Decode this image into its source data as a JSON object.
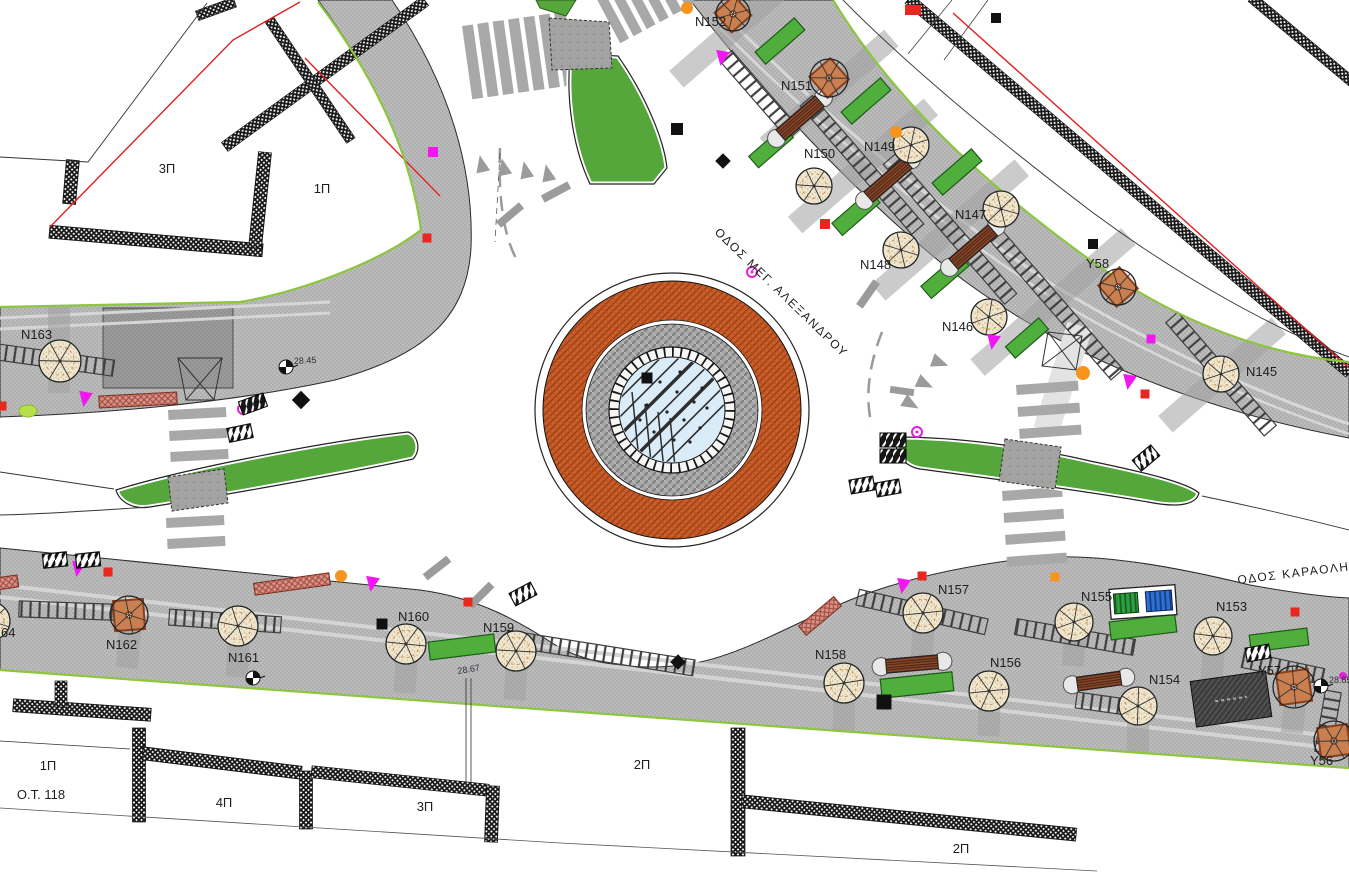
{
  "drawing": {
    "type": "site-plan",
    "units": "px"
  },
  "streets": [
    {
      "id": "meg-alexandrou",
      "name": "ΟΔΟΣ ΜΕΓ. ΑΛΕΞΑΝΔΡΟΥ",
      "x": 714,
      "y": 233,
      "rotate": 44
    },
    {
      "id": "karaoli",
      "name": "ΟΔΟΣ ΚΑΡΑΟΛΗ και",
      "x": 1238,
      "y": 584,
      "rotate": -7
    }
  ],
  "blocks": [
    {
      "text": "3Π",
      "x": 167,
      "y": 173
    },
    {
      "text": "1Π",
      "x": 322,
      "y": 193
    },
    {
      "text": "1Π",
      "x": 48,
      "y": 770
    },
    {
      "text": "Ο.Τ. 118",
      "x": 41,
      "y": 799
    },
    {
      "text": "4Π",
      "x": 224,
      "y": 807
    },
    {
      "text": "3Π",
      "x": 425,
      "y": 811
    },
    {
      "text": "2Π",
      "x": 642,
      "y": 769
    },
    {
      "text": "2Π",
      "x": 961,
      "y": 853
    }
  ],
  "elevations": [
    {
      "text": "28.45",
      "x": 294,
      "y": 364,
      "rot": -3
    },
    {
      "text": "28.67",
      "x": 458,
      "y": 674,
      "rot": -9
    },
    {
      "text": "28.85",
      "x": 1329,
      "y": 683,
      "rot": 0
    }
  ],
  "roundabout": {
    "cx": 672,
    "cy": 410,
    "r_outer": 137,
    "r_brick": 129,
    "r_gap": 90,
    "r_gray": 86,
    "r_tiles": 63,
    "r_glass": 53
  },
  "trees": [
    {
      "id": "N152",
      "x": 733,
      "y": 14,
      "type": "square",
      "r": 17,
      "s": 26,
      "prot": -41,
      "lx": 695,
      "ly": 26
    },
    {
      "id": "N151",
      "x": 829,
      "y": 78,
      "type": "square",
      "r": 19,
      "s": 28,
      "prot": -41,
      "lx": 781,
      "ly": 90
    },
    {
      "id": "N150",
      "x": 814,
      "y": 186,
      "type": "round",
      "r": 18,
      "lx": 804,
      "ly": 158
    },
    {
      "id": "N149",
      "x": 911,
      "y": 145,
      "type": "round",
      "r": 18,
      "lx": 864,
      "ly": 151
    },
    {
      "id": "N148",
      "x": 901,
      "y": 250,
      "type": "round",
      "r": 18,
      "lx": 860,
      "ly": 269
    },
    {
      "id": "N147",
      "x": 1001,
      "y": 209,
      "type": "round",
      "r": 18,
      "lx": 955,
      "ly": 219
    },
    {
      "id": "N146",
      "x": 989,
      "y": 317,
      "type": "round",
      "r": 18,
      "lx": 942,
      "ly": 331
    },
    {
      "id": "Y58",
      "x": 1118,
      "y": 287,
      "type": "square",
      "r": 18,
      "s": 28,
      "prot": -41,
      "lx": 1086,
      "ly": 268
    },
    {
      "id": "N145",
      "x": 1221,
      "y": 374,
      "type": "round",
      "r": 18,
      "lx": 1246,
      "ly": 376
    },
    {
      "id": "N163",
      "x": 60,
      "y": 361,
      "type": "round",
      "r": 21,
      "lx": 21,
      "ly": 339
    },
    {
      "id": "N164",
      "label": "64",
      "x": -9,
      "y": 621,
      "type": "round",
      "r": 19,
      "lx": 1,
      "ly": 637
    },
    {
      "id": "N162",
      "x": 129,
      "y": 615,
      "type": "square",
      "r": 19,
      "s": 30,
      "prot": -4,
      "lx": 106,
      "ly": 649
    },
    {
      "id": "N161",
      "x": 238,
      "y": 626,
      "type": "round",
      "r": 20,
      "lx": 228,
      "ly": 662
    },
    {
      "id": "N160",
      "x": 406,
      "y": 644,
      "type": "round",
      "r": 20,
      "lx": 398,
      "ly": 621
    },
    {
      "id": "N159",
      "x": 516,
      "y": 651,
      "type": "round",
      "r": 20,
      "lx": 483,
      "ly": 632
    },
    {
      "id": "N158",
      "x": 844,
      "y": 683,
      "type": "round",
      "r": 20,
      "lx": 815,
      "ly": 659
    },
    {
      "id": "N157",
      "x": 923,
      "y": 613,
      "type": "round",
      "r": 20,
      "lx": 938,
      "ly": 594
    },
    {
      "id": "N156",
      "x": 989,
      "y": 691,
      "type": "round",
      "r": 20,
      "lx": 990,
      "ly": 667
    },
    {
      "id": "N155",
      "x": 1074,
      "y": 622,
      "type": "round",
      "r": 19,
      "lx": 1081,
      "ly": 601
    },
    {
      "id": "N154",
      "x": 1138,
      "y": 706,
      "type": "round",
      "r": 19,
      "lx": 1149,
      "ly": 684
    },
    {
      "id": "N153",
      "x": 1213,
      "y": 636,
      "type": "round",
      "r": 19,
      "lx": 1216,
      "ly": 611
    },
    {
      "id": "Y57",
      "x": 1294,
      "y": 687,
      "type": "square",
      "r": 21,
      "s": 32,
      "prot": -8,
      "lx": 1258,
      "ly": 675
    },
    {
      "id": "Y56",
      "x": 1334,
      "y": 741,
      "type": "square",
      "r": 20,
      "s": 30,
      "prot": -8,
      "lx": 1310,
      "ly": 765
    }
  ],
  "benches_wood": [
    {
      "x": 800,
      "y": 118,
      "rot": -41,
      "len": 52
    },
    {
      "x": 888,
      "y": 180,
      "rot": -41,
      "len": 52
    },
    {
      "x": 973,
      "y": 247,
      "rot": -41,
      "len": 52
    },
    {
      "x": 912,
      "y": 664,
      "rot": -5,
      "len": 52
    },
    {
      "x": 1099,
      "y": 681,
      "rot": -8,
      "len": 44
    }
  ],
  "benches_pink": [
    {
      "x": 138,
      "y": 400,
      "rot": -3,
      "len": 78
    },
    {
      "x": 292,
      "y": 584,
      "rot": -8,
      "len": 76
    },
    {
      "x": 820,
      "y": 616,
      "rot": -40,
      "len": 46
    },
    {
      "x": 3,
      "y": 583,
      "rot": -8,
      "len": 30
    }
  ],
  "planters": [
    {
      "x": 780,
      "y": 41,
      "rot": -41,
      "w": 52,
      "h": 16
    },
    {
      "x": 866,
      "y": 101,
      "rot": -41,
      "w": 52,
      "h": 16
    },
    {
      "x": 771,
      "y": 147,
      "rot": -41,
      "w": 46,
      "h": 15
    },
    {
      "x": 856,
      "y": 213,
      "rot": -41,
      "w": 50,
      "h": 16
    },
    {
      "x": 957,
      "y": 172,
      "rot": -41,
      "w": 52,
      "h": 16
    },
    {
      "x": 945,
      "y": 276,
      "rot": -41,
      "w": 50,
      "h": 16
    },
    {
      "x": 1027,
      "y": 338,
      "rot": -41,
      "w": 44,
      "h": 15
    },
    {
      "x": 462,
      "y": 647,
      "rot": -7,
      "w": 66,
      "h": 18
    },
    {
      "x": 917,
      "y": 685,
      "rot": -6,
      "w": 72,
      "h": 19
    },
    {
      "x": 1143,
      "y": 627,
      "rot": -7,
      "w": 66,
      "h": 18
    },
    {
      "x": 1279,
      "y": 640,
      "rot": -7,
      "w": 58,
      "h": 17
    }
  ],
  "bins": {
    "x": 1143,
    "y": 602,
    "rot": -4
  },
  "kiosk": {
    "x": 1231,
    "y": 699,
    "rot": -8,
    "w": 76,
    "h": 46
  },
  "crosswalks": [
    {
      "x": 462,
      "y": 26,
      "n": 7,
      "w": 11,
      "h": 74,
      "step": 15.5,
      "dir": "v",
      "rot": -8
    },
    {
      "x": 593,
      "y": -8,
      "n": 6,
      "w": 10,
      "h": 58,
      "step": 15,
      "dir": "v",
      "rot": -28
    },
    {
      "x": 168,
      "y": 410,
      "n": 3,
      "w": 58,
      "h": 10,
      "step": 21,
      "dir": "h",
      "rot": -3
    },
    {
      "x": 166,
      "y": 518,
      "n": 2,
      "w": 58,
      "h": 10,
      "step": 21,
      "dir": "h",
      "rot": -3
    },
    {
      "x": 1016,
      "y": 385,
      "n": 3,
      "w": 62,
      "h": 10,
      "step": 22,
      "dir": "h",
      "rot": -4
    },
    {
      "x": 1002,
      "y": 491,
      "n": 4,
      "w": 60,
      "h": 10,
      "step": 22,
      "dir": "h",
      "rot": -4
    }
  ],
  "ladders": [
    {
      "x": 760,
      "y": 95,
      "len": 104,
      "rot": 49
    },
    {
      "x": 862,
      "y": 165,
      "len": 170,
      "rot": 49
    },
    {
      "x": 950,
      "y": 229,
      "len": 185,
      "rot": 49
    },
    {
      "x": 1053,
      "y": 301,
      "len": 195,
      "rot": 49
    },
    {
      "x": 1221,
      "y": 374,
      "len": 150,
      "rot": 49
    },
    {
      "x": 80,
      "y": 611,
      "len": 122,
      "rot": 2
    },
    {
      "x": 225,
      "y": 621,
      "len": 112,
      "rot": 4
    },
    {
      "x": 600,
      "y": 653,
      "len": 190,
      "rot": 9
    },
    {
      "x": 922,
      "y": 612,
      "len": 132,
      "rot": 13
    },
    {
      "x": 1075,
      "y": 637,
      "len": 120,
      "rot": 10
    },
    {
      "x": 1105,
      "y": 704,
      "len": 58,
      "rot": 8
    },
    {
      "x": 1283,
      "y": 668,
      "len": 82,
      "rot": 12
    },
    {
      "x": 1328,
      "y": 722,
      "len": 62,
      "rot": 100
    },
    {
      "x": 55,
      "y": 360,
      "len": 118,
      "rot": 8
    }
  ],
  "strips": [
    {
      "x": 733,
      "y": 30,
      "len": 150,
      "rot": 139
    },
    {
      "x": 829,
      "y": 92,
      "len": 165,
      "rot": 139
    },
    {
      "x": 863,
      "y": 166,
      "len": 180,
      "rot": 139
    },
    {
      "x": 950,
      "y": 230,
      "len": 190,
      "rot": 139
    },
    {
      "x": 1053,
      "y": 302,
      "len": 200,
      "rot": 139
    },
    {
      "x": 1222,
      "y": 375,
      "len": 150,
      "rot": 139
    },
    {
      "x": 129,
      "y": 642,
      "len": 52,
      "rot": 95
    },
    {
      "x": 238,
      "y": 652,
      "len": 50,
      "rot": 93
    },
    {
      "x": 406,
      "y": 670,
      "len": 46,
      "rot": 94
    },
    {
      "x": 516,
      "y": 678,
      "len": 44,
      "rot": 94
    },
    {
      "x": 844,
      "y": 708,
      "len": 44,
      "rot": 91
    },
    {
      "x": 989,
      "y": 716,
      "len": 40,
      "rot": 91
    },
    {
      "x": 1138,
      "y": 731,
      "len": 42,
      "rot": 91
    },
    {
      "x": 1294,
      "y": 713,
      "len": 40,
      "rot": 96
    },
    {
      "x": 1213,
      "y": 661,
      "len": 40,
      "rot": 94
    },
    {
      "x": 1074,
      "y": 647,
      "len": 38,
      "rot": 94
    },
    {
      "x": 923,
      "y": 637,
      "len": 40,
      "rot": 94
    },
    {
      "x": 59,
      "y": 350,
      "len": 86,
      "rot": 90
    }
  ],
  "walls": [
    {
      "x": 139,
      "y": 775,
      "len": 94,
      "w": 13,
      "rot": 90
    },
    {
      "x": 222,
      "y": 763,
      "len": 160,
      "w": 13,
      "rot": 7
    },
    {
      "x": 306,
      "y": 800,
      "len": 58,
      "w": 13,
      "rot": 90
    },
    {
      "x": 400,
      "y": 781,
      "len": 178,
      "w": 12,
      "rot": 6
    },
    {
      "x": 492,
      "y": 814,
      "len": 56,
      "w": 13,
      "rot": 92
    },
    {
      "x": 738,
      "y": 792,
      "len": 128,
      "w": 14,
      "rot": 90
    },
    {
      "x": 909,
      "y": 818,
      "len": 336,
      "w": 13,
      "rot": 5.7
    },
    {
      "x": 82,
      "y": 710,
      "len": 138,
      "w": 13,
      "rot": 4
    },
    {
      "x": 61,
      "y": 694,
      "len": 26,
      "w": 12,
      "rot": 90
    },
    {
      "x": 71,
      "y": 182,
      "len": 44,
      "w": 13,
      "rot": 95
    },
    {
      "x": 156,
      "y": 241,
      "len": 214,
      "w": 13,
      "rot": 5
    },
    {
      "x": 260,
      "y": 200,
      "len": 96,
      "w": 13,
      "rot": 96
    },
    {
      "x": 325,
      "y": 74,
      "len": 248,
      "w": 11,
      "rot": -36
    },
    {
      "x": 310,
      "y": 80,
      "len": 146,
      "w": 10,
      "rot": 56
    },
    {
      "x": 216,
      "y": 9,
      "len": 40,
      "w": 10,
      "rot": -20
    },
    {
      "x": 1129,
      "y": 186,
      "len": 578,
      "w": 11,
      "rot": 40.3
    },
    {
      "x": 1302,
      "y": 40,
      "len": 132,
      "w": 10,
      "rot": 40
    }
  ],
  "arrows": [
    {
      "x": 482,
      "y": 166,
      "rot": -12
    },
    {
      "x": 504,
      "y": 169,
      "rot": -12
    },
    {
      "x": 526,
      "y": 172,
      "rot": -12
    },
    {
      "x": 548,
      "y": 175,
      "rot": -12
    },
    {
      "x": 938,
      "y": 362,
      "rot": 110
    },
    {
      "x": 923,
      "y": 383,
      "rot": 115
    },
    {
      "x": 909,
      "y": 403,
      "rot": 120
    }
  ],
  "dashsegs": [
    {
      "x": 556,
      "y": 192,
      "rot": -28
    },
    {
      "x": 510,
      "y": 215,
      "rot": -40
    },
    {
      "x": 437,
      "y": 568,
      "rot": -38
    },
    {
      "x": 481,
      "y": 595,
      "rot": -45
    },
    {
      "x": 868,
      "y": 294,
      "rot": -55
    },
    {
      "x": 902,
      "y": 391,
      "rot": 8,
      "len": 24,
      "w": 7
    }
  ],
  "markers": [
    {
      "t": "sq",
      "c": "#f217f2",
      "x": 433,
      "y": 152,
      "s": 10
    },
    {
      "t": "tri",
      "c": "#f217f2",
      "x": 722,
      "y": 57
    },
    {
      "t": "tri",
      "c": "#f217f2",
      "x": 85,
      "y": 398
    },
    {
      "t": "ring",
      "c": "#e020e0",
      "x": 243,
      "y": 409
    },
    {
      "t": "ring",
      "c": "#e020e0",
      "x": 752,
      "y": 272
    },
    {
      "t": "ring",
      "c": "#e020e0",
      "x": 917,
      "y": 432
    },
    {
      "t": "tri",
      "c": "#f217f2",
      "x": 993,
      "y": 341
    },
    {
      "t": "tri",
      "c": "#f217f2",
      "x": 1129,
      "y": 381
    },
    {
      "t": "tri",
      "c": "#f217f2",
      "x": 78,
      "y": 568
    },
    {
      "t": "tri",
      "c": "#f217f2",
      "x": 372,
      "y": 583
    },
    {
      "t": "tri",
      "c": "#f217f2",
      "x": 903,
      "y": 585
    },
    {
      "t": "sq",
      "c": "#f217f2",
      "x": 1151,
      "y": 339,
      "s": 9
    },
    {
      "t": "dot",
      "c": "#e020e0",
      "x": 1343,
      "y": 676,
      "s": 4
    },
    {
      "t": "dot",
      "c": "#f7941d",
      "x": 687,
      "y": 8,
      "s": 6
    },
    {
      "t": "dot",
      "c": "#f7941d",
      "x": 896,
      "y": 132,
      "s": 6
    },
    {
      "t": "dot",
      "c": "#f7941d",
      "x": 1083,
      "y": 373,
      "s": 7
    },
    {
      "t": "dot",
      "c": "#f7941d",
      "x": 341,
      "y": 576,
      "s": 6
    },
    {
      "t": "sq",
      "c": "#f7941d",
      "x": 1055,
      "y": 577,
      "s": 9
    },
    {
      "t": "sq",
      "c": "#e8281e",
      "x": 825,
      "y": 224,
      "s": 10
    },
    {
      "t": "sq",
      "c": "#e8281e",
      "x": 2,
      "y": 406,
      "s": 9
    },
    {
      "t": "sq",
      "c": "#e8281e",
      "x": 108,
      "y": 572,
      "s": 9
    },
    {
      "t": "sq",
      "c": "#e8281e",
      "x": 468,
      "y": 602,
      "s": 9
    },
    {
      "t": "sq",
      "c": "#e8281e",
      "x": 922,
      "y": 576,
      "s": 9
    },
    {
      "t": "sq",
      "c": "#e8281e",
      "x": 1145,
      "y": 394,
      "s": 9
    },
    {
      "t": "sq",
      "c": "#e8281e",
      "x": 1295,
      "y": 612,
      "s": 9
    },
    {
      "t": "sq",
      "c": "#e8281e",
      "x": 427,
      "y": 238,
      "s": 9
    },
    {
      "t": "rect",
      "c": "#e8281e",
      "x": 913,
      "y": 10,
      "s": 16
    },
    {
      "t": "sq",
      "c": "#111111",
      "x": 647,
      "y": 378,
      "s": 11
    },
    {
      "t": "sq",
      "c": "#111111",
      "x": 677,
      "y": 129,
      "s": 12
    },
    {
      "t": "dia",
      "c": "#111111",
      "x": 723,
      "y": 161,
      "s": 11
    },
    {
      "t": "dia",
      "c": "#111111",
      "x": 301,
      "y": 400,
      "s": 13
    },
    {
      "t": "sq",
      "c": "#111111",
      "x": 996,
      "y": 18,
      "s": 10
    },
    {
      "t": "sq",
      "c": "#111111",
      "x": 1093,
      "y": 244,
      "s": 10
    },
    {
      "t": "sq",
      "c": "#111111",
      "x": 382,
      "y": 624,
      "s": 11
    },
    {
      "t": "sq",
      "c": "#111111",
      "x": 884,
      "y": 702,
      "s": 15
    },
    {
      "t": "dia",
      "c": "#111111",
      "x": 678,
      "y": 662,
      "s": 11
    },
    {
      "t": "lime",
      "c": "#b5e04a",
      "x": 28,
      "y": 411
    },
    {
      "t": "hatch",
      "x": 240,
      "y": 433,
      "rot": -12
    },
    {
      "t": "hatch",
      "x": 55,
      "y": 560,
      "rot": -6
    },
    {
      "t": "hatch",
      "x": 88,
      "y": 560,
      "rot": -6
    },
    {
      "t": "hatch",
      "x": 862,
      "y": 485,
      "rot": -10
    },
    {
      "t": "hatch",
      "x": 888,
      "y": 488,
      "rot": -10
    },
    {
      "t": "hatch",
      "x": 1146,
      "y": 458,
      "rot": -40
    },
    {
      "t": "hatch",
      "x": 523,
      "y": 594,
      "rot": -28
    },
    {
      "t": "hatch",
      "x": 1258,
      "y": 653,
      "rot": -10
    },
    {
      "t": "hatchdark",
      "x": 893,
      "y": 440,
      "rot": 0
    },
    {
      "t": "hatchdark",
      "x": 893,
      "y": 456,
      "rot": 0
    },
    {
      "t": "hatchdark",
      "x": 253,
      "y": 404,
      "rot": -20
    },
    {
      "t": "surv",
      "x": 286,
      "y": 367
    },
    {
      "t": "surv",
      "x": 253,
      "y": 678
    },
    {
      "t": "surv",
      "x": 1321,
      "y": 686
    }
  ],
  "colors": {
    "sidewalk": "#bcbcbc",
    "sidewalk_dark": "#9c9c9c",
    "green": "#55a63b",
    "brick": "#cc5d28",
    "glass": "#d9ecf8",
    "bench": "#8a4a2c",
    "pink_bench": "#d89287",
    "magenta": "#f217f2",
    "orange": "#f7941d",
    "red": "#e8281e",
    "lime": "#b5e04a",
    "boundary_red": "#e02020",
    "edge_green": "#8cc63f"
  }
}
